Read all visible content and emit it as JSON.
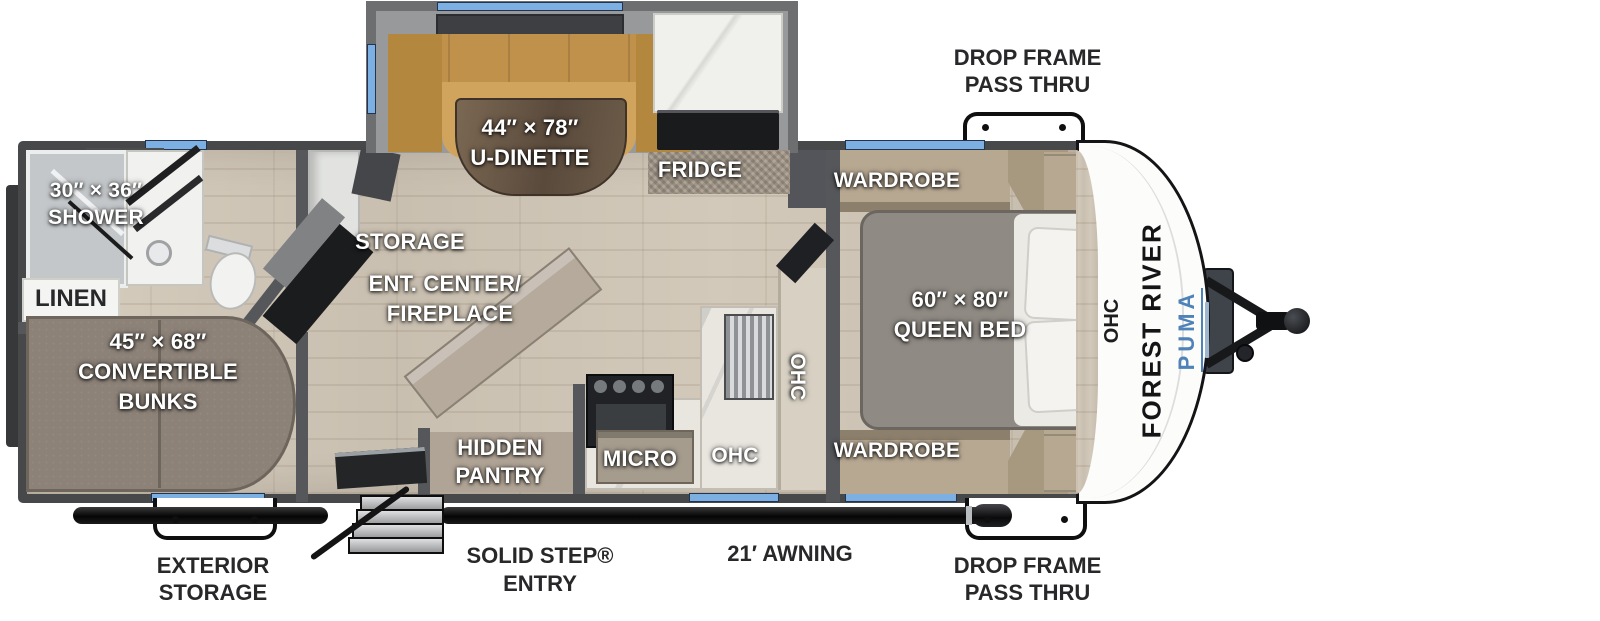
{
  "plan": {
    "type": "rv-floor-plan",
    "brand": "FOREST RIVER",
    "model": "PUMA",
    "colors": {
      "window_blue": "#7db0e2",
      "wall_gray": "#55575a",
      "floor_tan": "#cfc5b6",
      "dinette_tan": "#c59750",
      "brand_blue": "#4e82b8",
      "label_white": "#ffffff",
      "label_dark": "#28282a"
    },
    "labels": {
      "shower": [
        "30″ × 36″",
        "SHOWER"
      ],
      "linen": "LINEN",
      "dinette": [
        "44″ × 78″",
        "U-DINETTE"
      ],
      "fridge": "FRIDGE",
      "storage": "STORAGE",
      "ent_center": [
        "ENT. CENTER/",
        "FIREPLACE"
      ],
      "bunks": [
        "45″ × 68″",
        "CONVERTIBLE",
        "BUNKS"
      ],
      "hidden_pantry": [
        "HIDDEN",
        "PANTRY"
      ],
      "micro": "MICRO",
      "ohc": "OHC",
      "wardrobe_top": "WARDROBE",
      "wardrobe_bottom": "WARDROBE",
      "queen_bed": [
        "60″ × 80″",
        "QUEEN BED"
      ],
      "ohc_front": "OHC",
      "drop_frame_top": [
        "DROP FRAME",
        "PASS THRU"
      ],
      "drop_frame_bottom": [
        "DROP FRAME",
        "PASS THRU"
      ],
      "exterior_storage": [
        "EXTERIOR",
        "STORAGE"
      ],
      "solid_step": [
        "SOLID STEP®",
        "ENTRY"
      ],
      "awning": "21′ AWNING"
    }
  }
}
